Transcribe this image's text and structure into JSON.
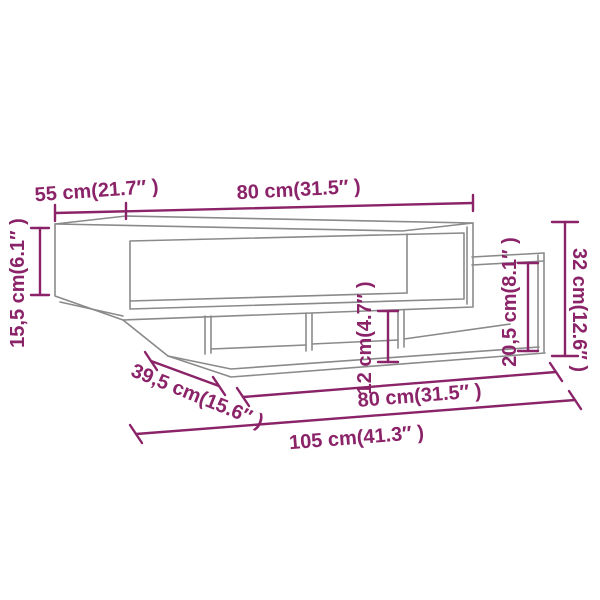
{
  "diagram": {
    "type": "furniture-dimension-diagram",
    "subject": "coffee table line drawing",
    "colors": {
      "dimension": "#8b2368",
      "outline": "#8a8a8a",
      "background": "#ffffff"
    },
    "dimensions": {
      "top_depth": {
        "label": "55 cm(21.7″ )",
        "cm": "55",
        "inches": "21.7"
      },
      "top_width": {
        "label": "80 cm(31.5″ )",
        "cm": "80",
        "inches": "31.5"
      },
      "top_box_height": {
        "label": "15,5 cm(6.1″ )",
        "cm": "15,5",
        "inches": "6.1"
      },
      "shelf_clearance": {
        "label": "12 cm(4.7″ )",
        "cm": "12",
        "inches": "4.7"
      },
      "side_shelf_height": {
        "label": "20,5 cm(8.1″ )",
        "cm": "20,5",
        "inches": "8.1"
      },
      "total_height": {
        "label": "32 cm(12.6″ )",
        "cm": "32",
        "inches": "12.6"
      },
      "shelf_depth": {
        "label": "39,5 cm(15.6″ )",
        "cm": "39,5",
        "inches": "15.6"
      },
      "shelf_width": {
        "label": "80 cm(31.5″ )",
        "cm": "80",
        "inches": "31.5"
      },
      "total_width": {
        "label": "105 cm(41.3″ )",
        "cm": "105",
        "inches": "41.3"
      }
    }
  }
}
